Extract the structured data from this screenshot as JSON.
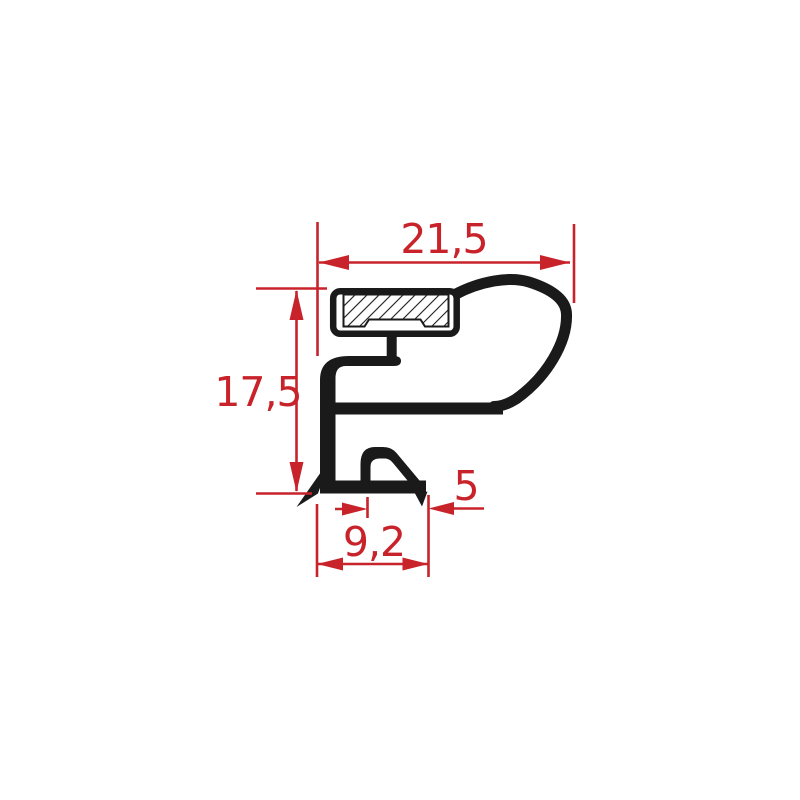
{
  "diagram": {
    "kind_label": "gasket-profile-cross-section",
    "dimensions": {
      "top_width": "21,5",
      "left_height": "17,5",
      "bottom_width": "9,2",
      "bottom_offset": "5"
    },
    "colors": {
      "dimension_red": "#c8232a",
      "profile_black": "#1a1a1a",
      "background": "#ffffff"
    }
  }
}
